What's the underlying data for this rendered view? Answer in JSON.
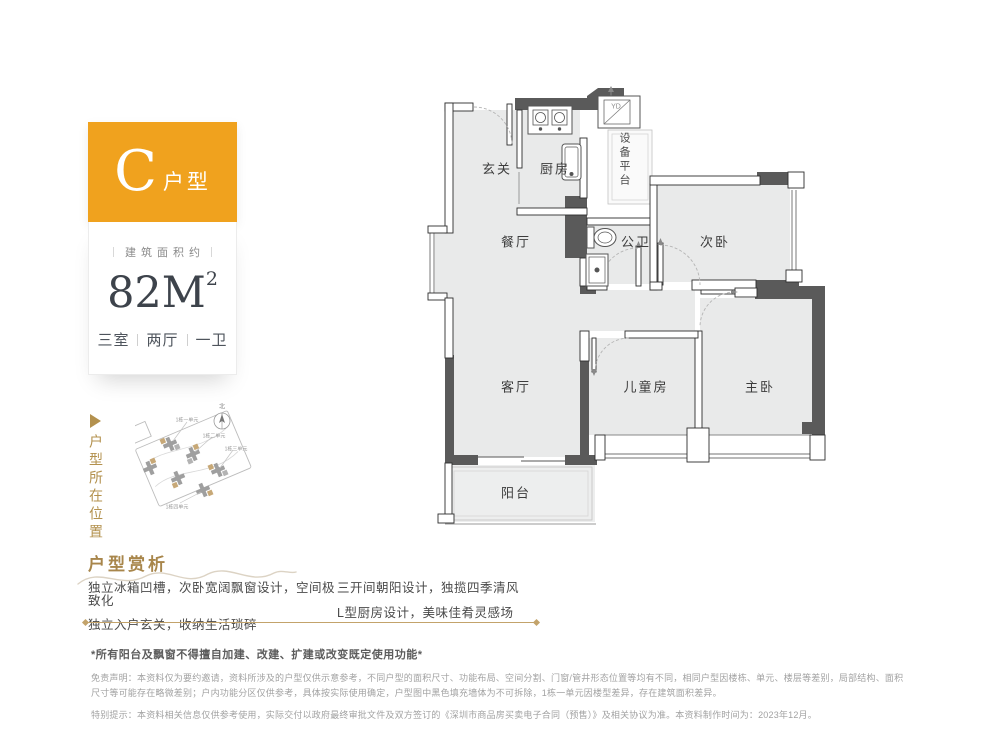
{
  "unit_card": {
    "letter": "C",
    "type_suffix": "户型",
    "area_label": "建筑面积约",
    "area_value": "82M",
    "area_sup": "2",
    "layout_parts": [
      "三室",
      "两厅",
      "一卫"
    ]
  },
  "location": {
    "side_label": "户型所在位置",
    "compass_label": "北",
    "buildings": [
      "1栋一单元",
      "1栋二单元",
      "1栋三单元",
      "1栋四单元"
    ]
  },
  "floorplan": {
    "rooms": {
      "entry": "玄关",
      "kitchen": "厨房",
      "equipment": "设备平台",
      "dining": "餐厅",
      "bath": "公卫",
      "bedroom2": "次卧",
      "living": "客厅",
      "kids": "儿童房",
      "master": "主卧",
      "balcony": "阳台",
      "yd": "YD"
    }
  },
  "analysis": {
    "title": "户型赏析",
    "bullets_left": [
      "独立冰箱凹槽，次卧宽阔飘窗设计，空间极致化",
      "独立入户玄关，收纳生活琐碎"
    ],
    "bullets_right": [
      "三开间朝阳设计，独揽四季清风",
      "L型厨房设计，美味佳肴灵感场"
    ]
  },
  "disclaimer": {
    "notice": "*所有阳台及飘窗不得擅自加建、改建、扩建或改变既定使用功能*",
    "statement": "免责声明：本资料仅为要约邀请，资料所涉及的户型仅供示意参考，不同户型的面积尺寸、功能布局、空间分割、门窗/管井形态位置等均有不同，相同户型因楼栋、单元、楼层等差别，局部结构、面积尺寸等可能存在略微差别；户内功能分区仅供参考，具体按实际使用确定，户型图中黑色填充墙体为不可拆除，1栋一单元因楼型差异，存在建筑面积差异。",
    "special": "特别提示：本资料相关信息仅供参考使用，实际交付以政府最终审批文件及双方签订的《深圳市商品房买卖电子合同（预售）》及相关协议为准。本资料制作时间为：2023年12月。"
  },
  "colors": {
    "accent_orange": "#F0A21E",
    "gold": "#B3914E",
    "wall_dark": "#5A5A5A",
    "room_fill": "#E9EAEA"
  }
}
